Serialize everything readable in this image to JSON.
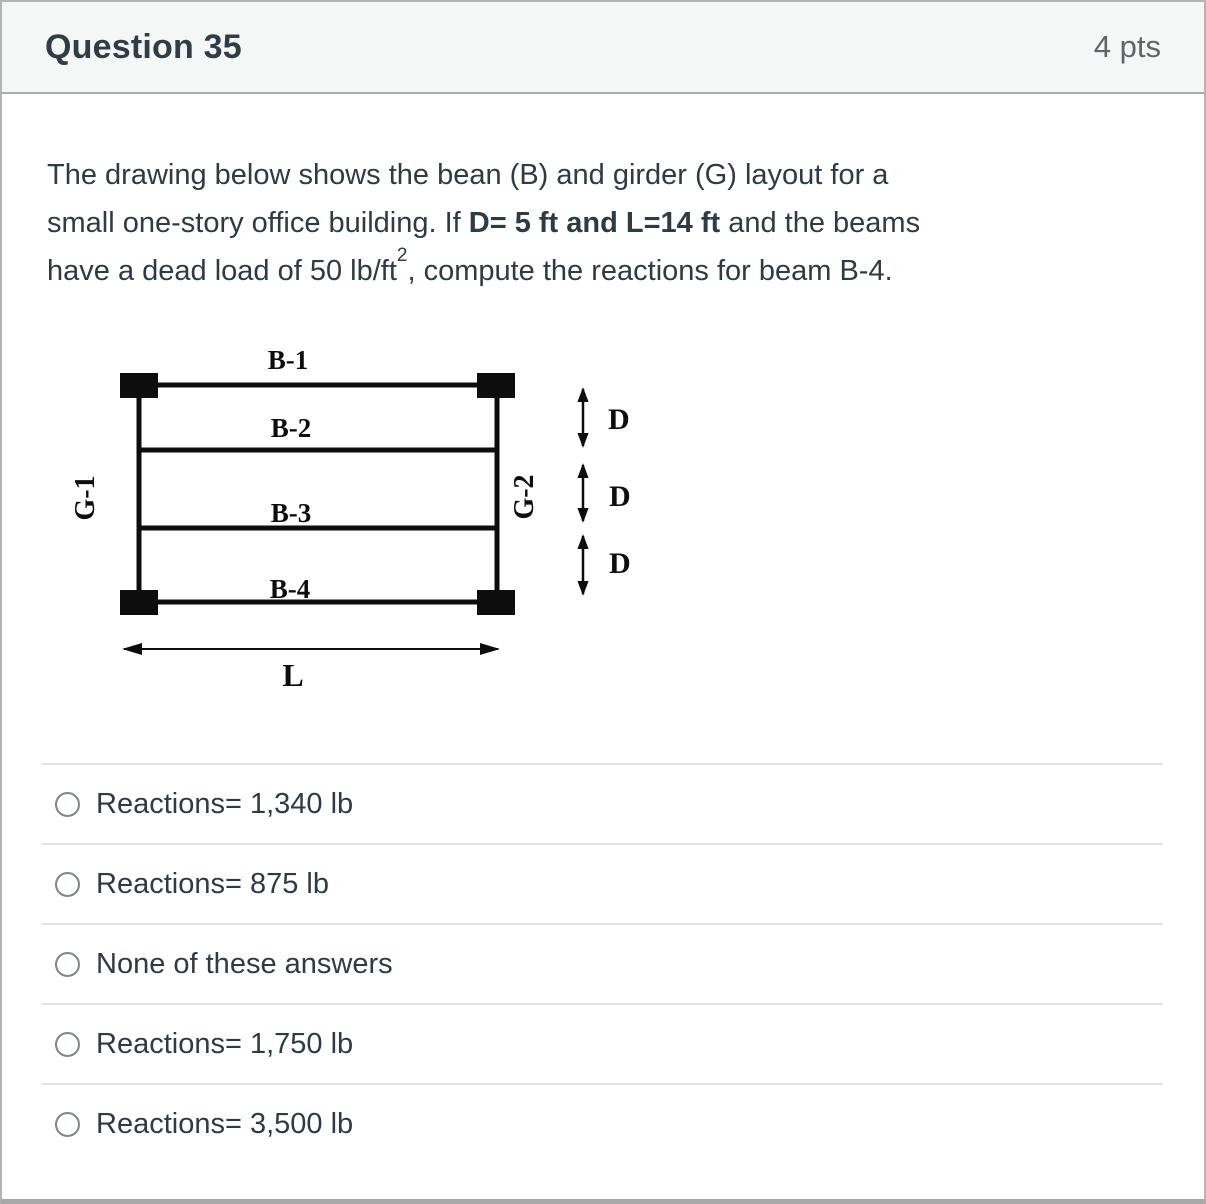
{
  "header": {
    "title": "Question 35",
    "points": "4 pts"
  },
  "question": {
    "line1": "The drawing below shows the bean (B) and girder (G) layout for a",
    "line2_pre": "small one-story office building. If ",
    "line2_bold": "D= 5 ft and L=14 ft",
    "line2_post": " and the beams",
    "line3_pre": "have a dead load of 50 lb/ft",
    "line3_sup": "2",
    "line3_post": ", compute the reactions for beam B-4."
  },
  "diagram": {
    "beam_labels": [
      "B-1",
      "B-2",
      "B-3",
      "B-4"
    ],
    "girder_labels": [
      "G-1",
      "G-2"
    ],
    "dim_labels": [
      "D",
      "D",
      "D"
    ],
    "span_label": "L"
  },
  "options": [
    {
      "label": "Reactions= 1,340 lb"
    },
    {
      "label": "Reactions= 875 lb"
    },
    {
      "label": "None of these answers"
    },
    {
      "label": "Reactions= 1,750 lb"
    },
    {
      "label": "Reactions= 3,500 lb"
    }
  ],
  "colors": {
    "text": "#2d3b45",
    "muted_text": "#5e6669",
    "header_bg": "#f5f6f6",
    "card_border": "#b4b4b4",
    "divider": "#e2e2e2",
    "radio_border": "#7f8588",
    "diagram_ink": "#0d0d0d"
  }
}
